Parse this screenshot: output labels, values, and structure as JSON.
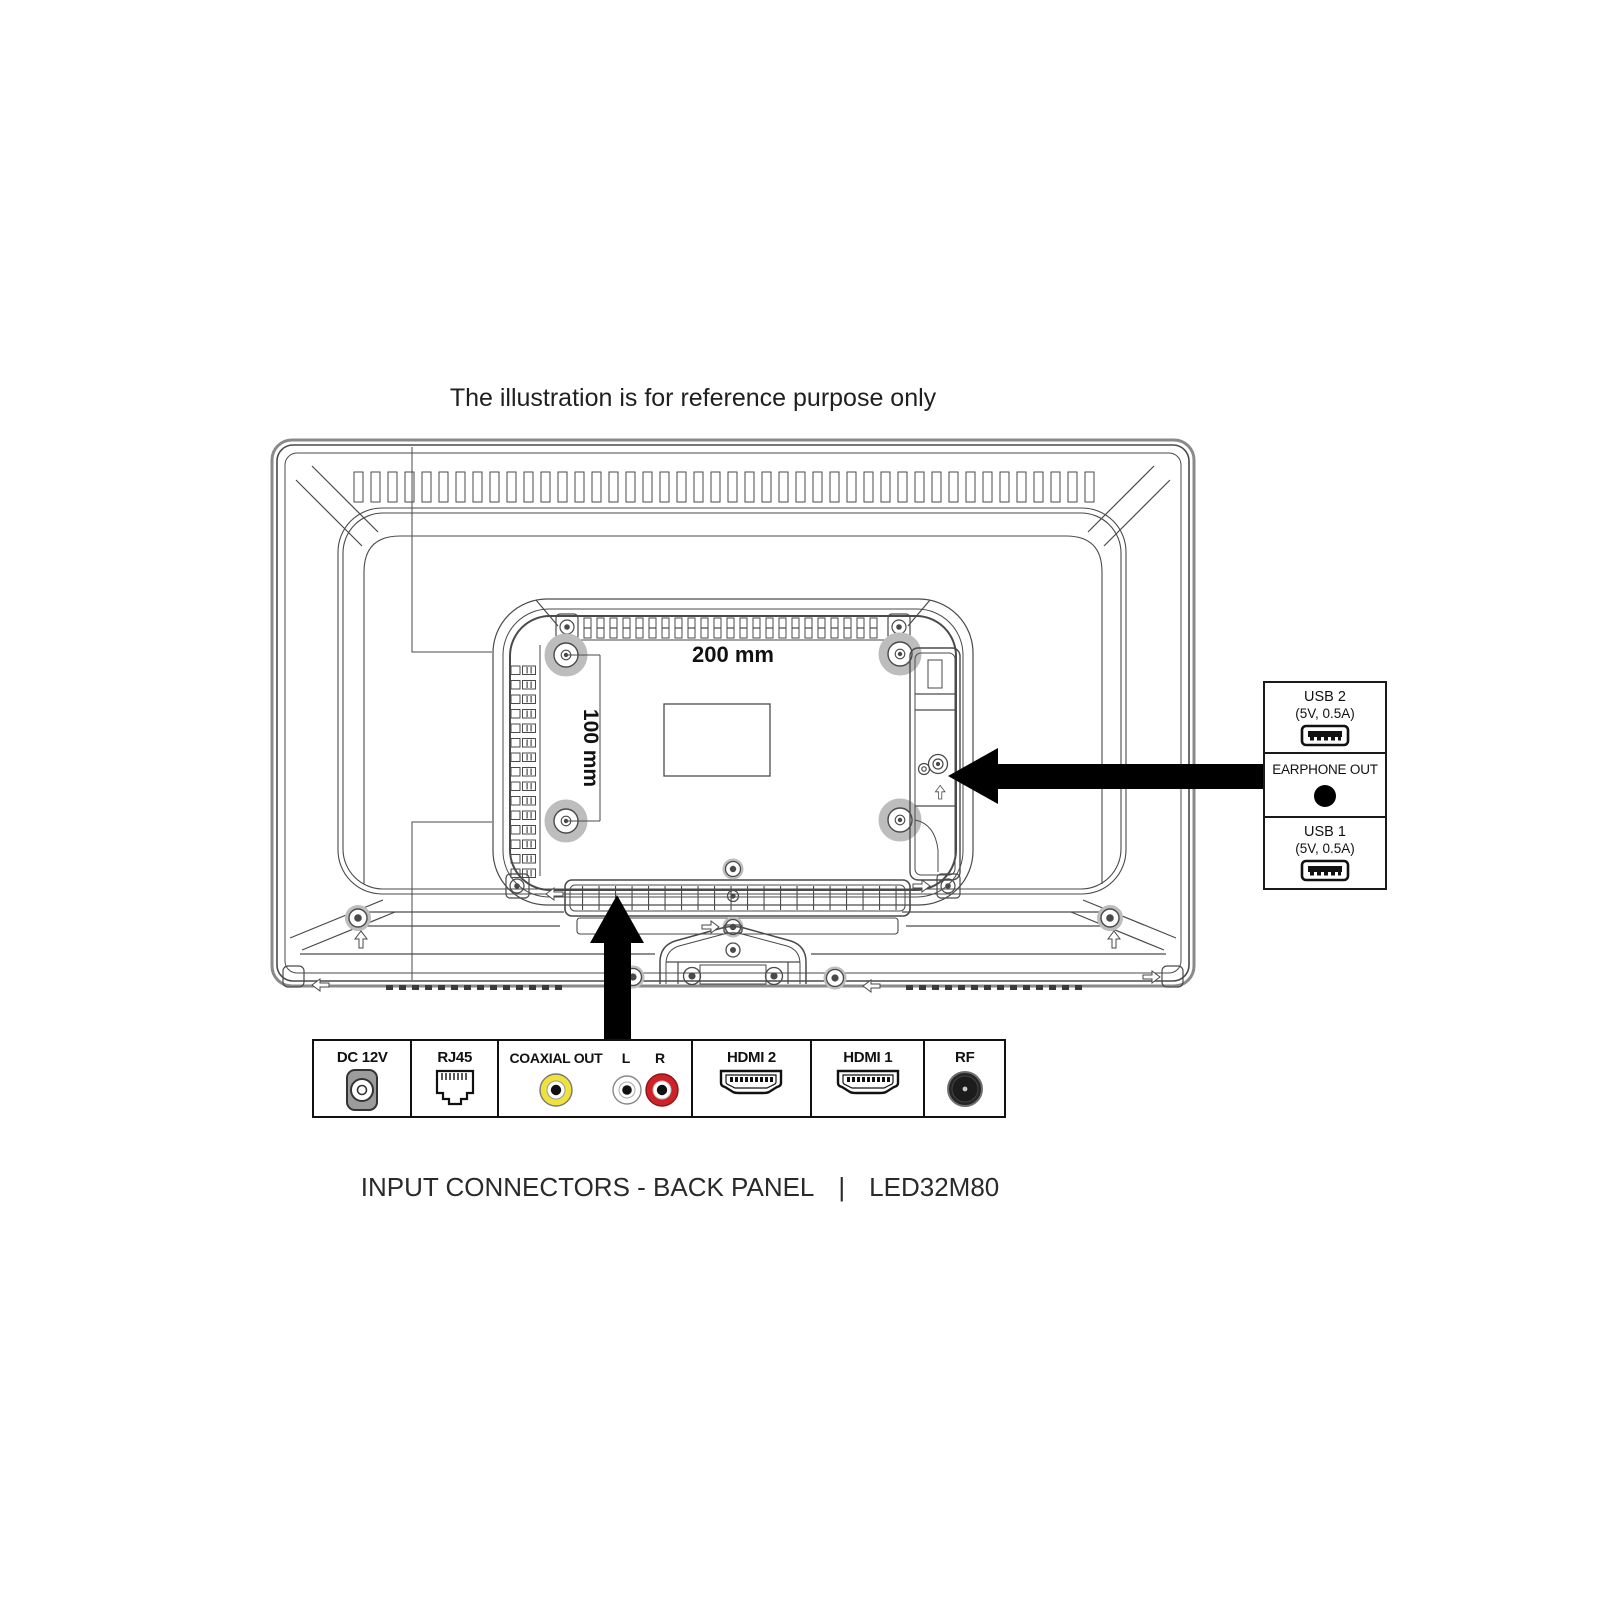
{
  "title": "The illustration is for reference purpose only",
  "diagram": {
    "dimension_horizontal": "200 mm",
    "dimension_vertical": "100 mm"
  },
  "side_panel": {
    "usb2": {
      "label": "USB 2",
      "spec": "(5V, 0.5A)",
      "icon": "usb-port-icon"
    },
    "earphone": {
      "label": "EARPHONE OUT",
      "icon": "earphone-jack-icon"
    },
    "usb1": {
      "label": "USB 1",
      "spec": "(5V, 0.5A)",
      "icon": "usb-port-icon"
    }
  },
  "bottom_panel": {
    "dc": {
      "label": "DC 12V",
      "icon": "dc-power-jack-icon"
    },
    "rj45": {
      "label": "RJ45",
      "icon": "ethernet-port-icon"
    },
    "av": {
      "coaxial": {
        "label": "COAXIAL OUT",
        "icon": "rca-jack-icon",
        "color": "#efe23c"
      },
      "left": {
        "label": "L",
        "icon": "rca-jack-icon",
        "color": "#ffffff"
      },
      "right": {
        "label": "R",
        "icon": "rca-jack-icon",
        "color": "#cf2127"
      }
    },
    "hdmi2": {
      "label": "HDMI 2",
      "icon": "hdmi-port-icon"
    },
    "hdmi1": {
      "label": "HDMI 1",
      "icon": "hdmi-port-icon"
    },
    "rf": {
      "label": "RF",
      "icon": "rf-antenna-icon"
    }
  },
  "caption": {
    "text": "INPUT CONNECTORS - BACK PANEL",
    "separator": "|",
    "model": "LED32M80"
  },
  "colors": {
    "line": "#4a4a4a",
    "arrow": "#000000",
    "rca_yellow": "#efe23c",
    "rca_red": "#cf2127",
    "dc_gray": "#9c9c9c"
  }
}
